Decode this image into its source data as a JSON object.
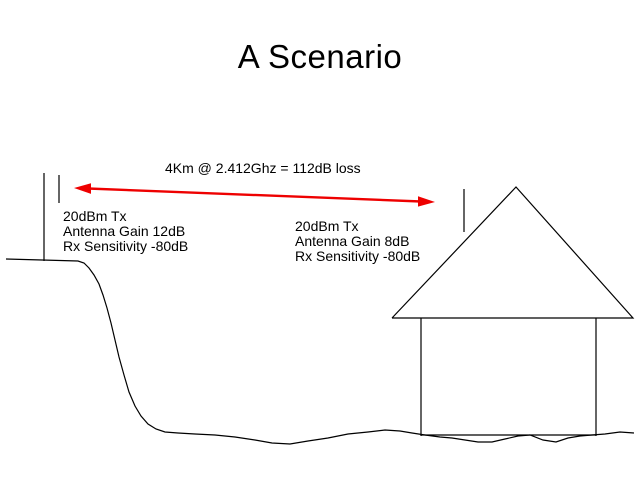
{
  "slide": {
    "title": "A Scenario",
    "link": {
      "label": "4Km @ 2.412Ghz = 112dB loss"
    },
    "left_station": {
      "lines": [
        "20dBm Tx",
        "Antenna Gain 12dB",
        "Rx Sensitivity -80dB"
      ]
    },
    "right_station": {
      "lines": [
        "20dBm Tx",
        "Antenna Gain 8dB",
        "Rx Sensitivity -80dB"
      ]
    },
    "colors": {
      "arrow_red": "#ee0000",
      "line_black": "#000000",
      "background": "#ffffff"
    }
  }
}
